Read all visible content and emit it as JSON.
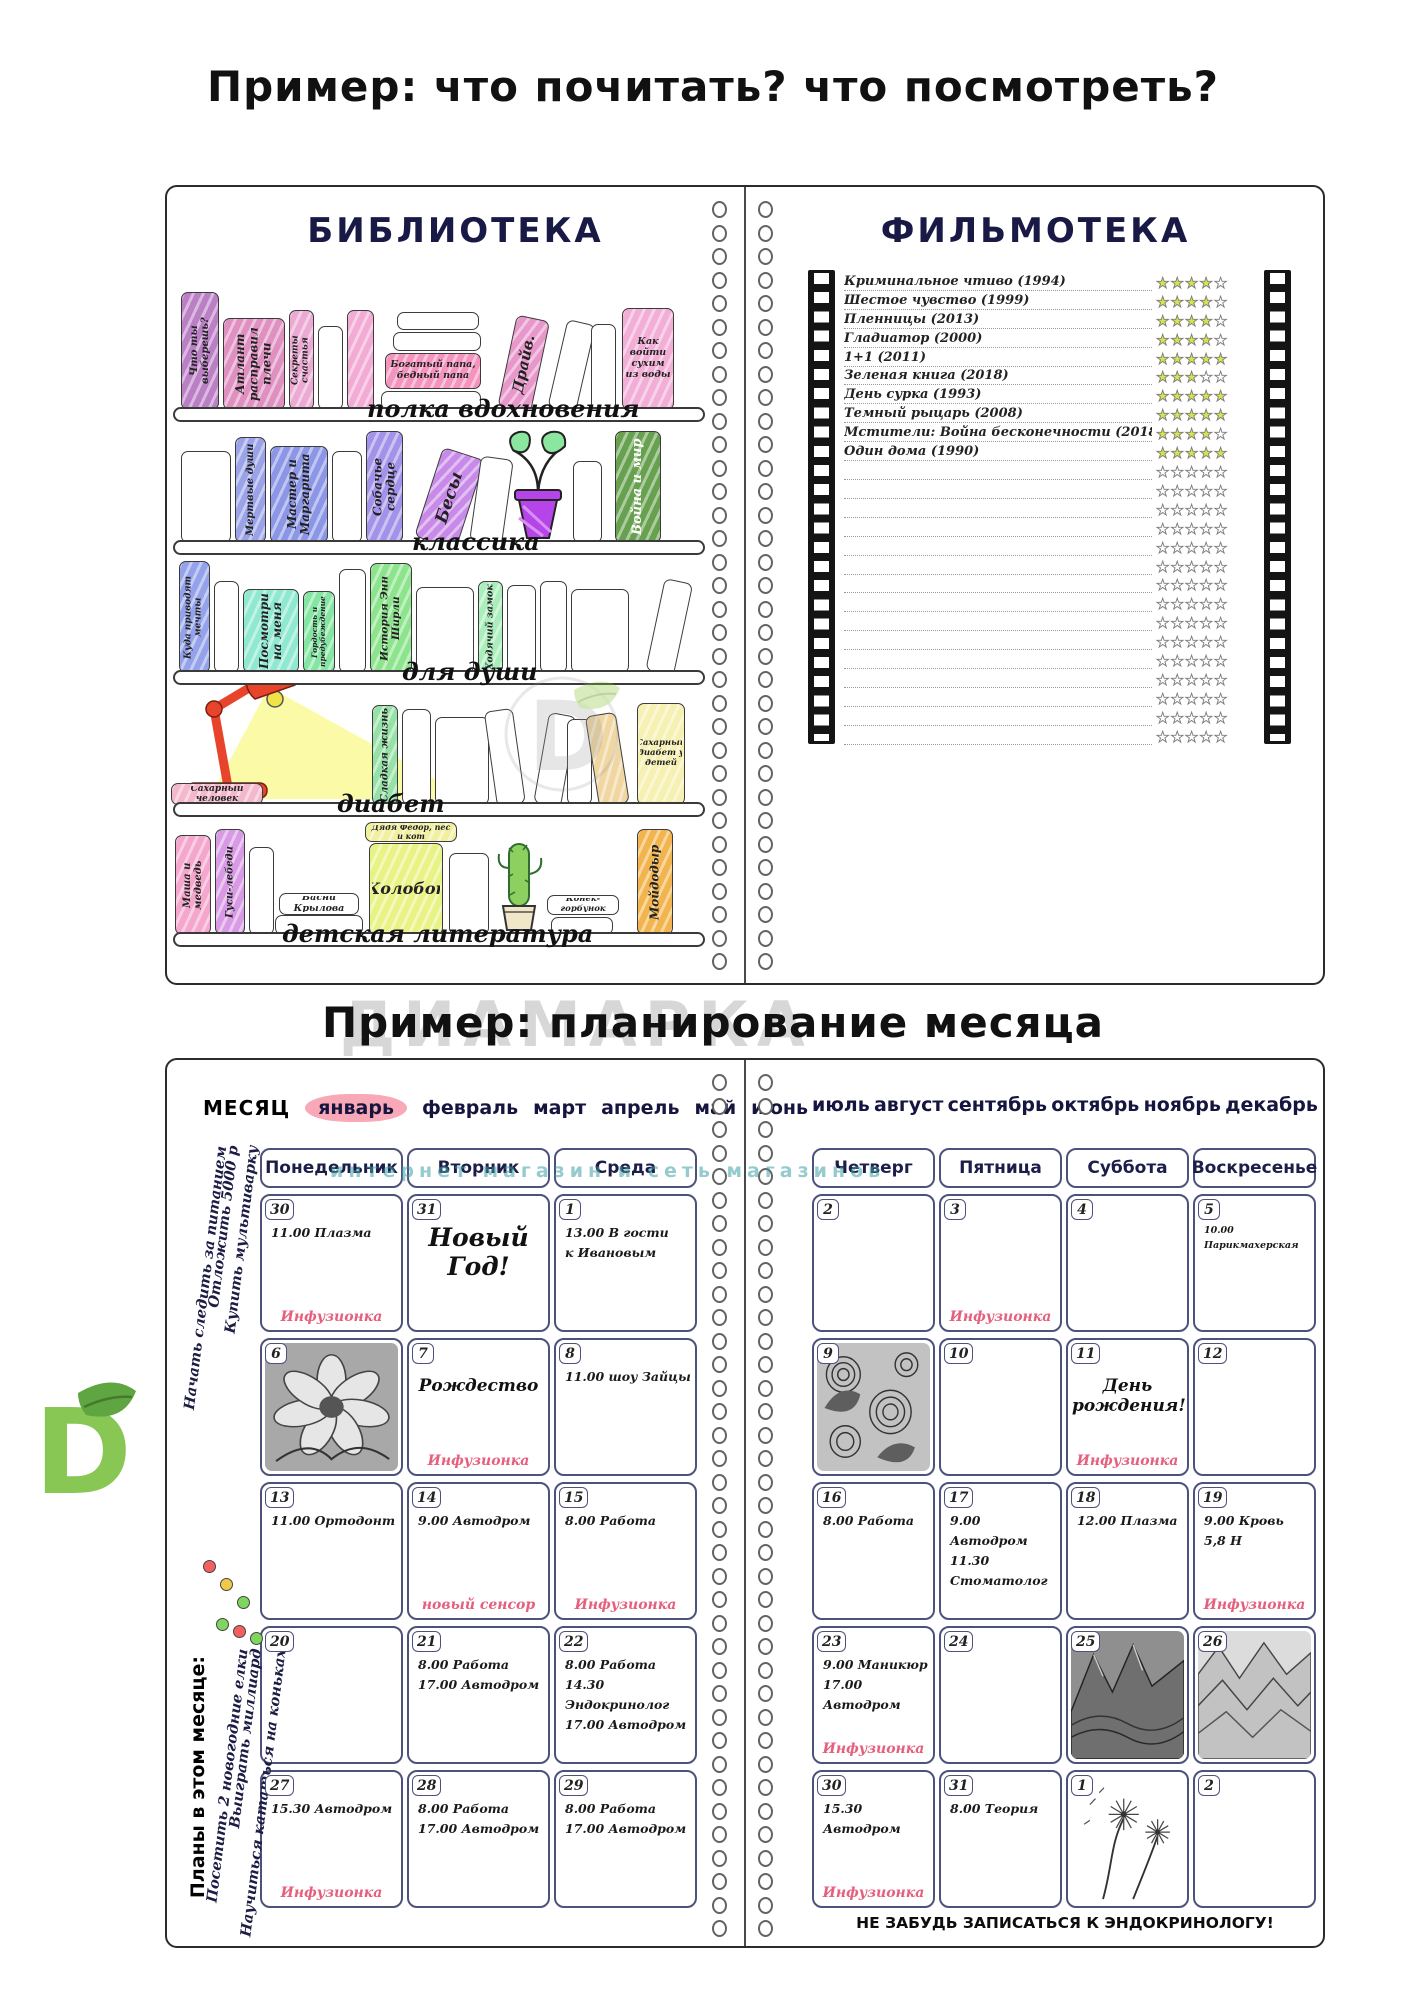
{
  "titles": {
    "example1": "Пример: что почитать? что посмотреть?",
    "example2": "Пример: планирование месяца"
  },
  "colors": {
    "navy_title": "#191946",
    "accent_red": "#e4607c",
    "star_fill": "#d7e44e",
    "month_highlight": "#f8a8b6"
  },
  "library": {
    "title": "БИБЛИОТЕКА",
    "shelves": [
      {
        "label": "полка вдохновения",
        "bar": 220,
        "label_x": 200,
        "books": [
          {
            "t": "Что ты выберешь?",
            "c": "#bb7fc6",
            "x": 14,
            "w": 38,
            "h": 118,
            "fs": 10
          },
          {
            "t": "Атлант расправил плечи",
            "c": "#df8fc0",
            "x": 56,
            "w": 62,
            "h": 92,
            "fs": 12
          },
          {
            "t": "Секреты счастья",
            "c": "#eba9d4",
            "x": 122,
            "w": 25,
            "h": 100,
            "fs": 9
          },
          {
            "c": "#ffffff",
            "x": 151,
            "w": 25,
            "h": 84
          },
          {
            "c": "#f2abd4",
            "x": 180,
            "w": 27,
            "h": 100
          },
          {
            "c": "#ffffff",
            "x": 214,
            "w": 100,
            "h": 19,
            "lying": 1,
            "b": 0
          },
          {
            "t": "Богатый папа, бедный папа",
            "c": "#f493be",
            "x": 218,
            "w": 96,
            "h": 36,
            "lying": 1,
            "b": 21,
            "fs": 9.5
          },
          {
            "c": "#ffffff",
            "x": 226,
            "w": 88,
            "h": 19,
            "lying": 1,
            "b": 59
          },
          {
            "c": "#ffffff",
            "x": 230,
            "w": 82,
            "h": 18,
            "lying": 1,
            "b": 80
          },
          {
            "t": "Драйв.",
            "c": "#e897ca",
            "x": 330,
            "w": 34,
            "h": 94,
            "tilt": 12,
            "fs": 15
          },
          {
            "c": "#ffffff",
            "x": 380,
            "w": 29,
            "h": 90,
            "tilt": 13
          },
          {
            "c": "#ffffff",
            "x": 424,
            "w": 25,
            "h": 86
          },
          {
            "t": "Как войти сухим из воды",
            "c": "#f2aed6",
            "x": 455,
            "w": 52,
            "h": 102,
            "hl": 1,
            "fs": 9.5
          }
        ]
      },
      {
        "label": "классика",
        "bar": 353,
        "label_x": 245,
        "books": [
          {
            "c": "#ffffff",
            "x": 14,
            "w": 50,
            "h": 92
          },
          {
            "t": "Мертвые души",
            "c": "#9aa2e8",
            "x": 68,
            "w": 31,
            "h": 106,
            "fs": 10
          },
          {
            "t": "Мастер и Маргарита",
            "c": "#8c96e6",
            "x": 103,
            "w": 58,
            "h": 97,
            "fs": 12
          },
          {
            "c": "#ffffff",
            "x": 165,
            "w": 30,
            "h": 92
          },
          {
            "t": "Собачье сердце",
            "c": "#a392ea",
            "x": 199,
            "w": 37,
            "h": 112,
            "fs": 12
          },
          {
            "t": "Бесы",
            "c": "#c88ae8",
            "x": 246,
            "w": 44,
            "h": 94,
            "tilt": 18,
            "fs": 17
          },
          {
            "c": "#ffffff",
            "x": 302,
            "w": 33,
            "h": 86,
            "tilt": 8
          },
          {
            "c": "#ffffff",
            "x": 406,
            "w": 29,
            "h": 82
          },
          {
            "t": "Война и мир",
            "c": "#67a04e",
            "x": 448,
            "w": 46,
            "h": 112,
            "fs": 13,
            "tc": "#ffffff"
          }
        ]
      },
      {
        "label": "для души",
        "bar": 483,
        "label_x": 235,
        "books": [
          {
            "t": "Куда приводят мечты",
            "c": "#93a2ea",
            "x": 12,
            "w": 31,
            "h": 112,
            "fs": 9
          },
          {
            "c": "#ffffff",
            "x": 47,
            "w": 25,
            "h": 92
          },
          {
            "t": "Посмотри на меня",
            "c": "#8fe8d0",
            "x": 76,
            "w": 56,
            "h": 84,
            "fs": 12
          },
          {
            "t": "Гордость и предубеждение",
            "c": "#84e6a2",
            "x": 136,
            "w": 32,
            "h": 82,
            "fs": 7.5
          },
          {
            "c": "#ffffff",
            "x": 172,
            "w": 27,
            "h": 104
          },
          {
            "t": "История Энн Ширли",
            "c": "#8ce48c",
            "x": 203,
            "w": 42,
            "h": 110,
            "fs": 10.5
          },
          {
            "c": "#ffffff",
            "x": 249,
            "w": 58,
            "h": 86
          },
          {
            "t": "Ходячий замок",
            "c": "#aaeebc",
            "x": 311,
            "w": 25,
            "h": 92,
            "fs": 9.5
          },
          {
            "c": "#ffffff",
            "x": 340,
            "w": 29,
            "h": 88
          },
          {
            "c": "#ffffff",
            "x": 373,
            "w": 27,
            "h": 92
          },
          {
            "c": "#ffffff",
            "x": 404,
            "w": 58,
            "h": 84
          },
          {
            "c": "#ffffff",
            "x": 478,
            "w": 29,
            "h": 94,
            "tilt": 12
          }
        ]
      },
      {
        "label": "диабет",
        "bar": 615,
        "label_x": 170,
        "books": [
          {
            "t": "Сахарный человек",
            "c": "#f4b8cc",
            "x": 4,
            "w": 92,
            "h": 22,
            "lying": 1,
            "b": 0,
            "fs": 9
          },
          {
            "t": "Сладкая жизнь",
            "c": "#96e2a6",
            "x": 205,
            "w": 26,
            "h": 100,
            "fs": 10
          },
          {
            "c": "#ffffff",
            "x": 235,
            "w": 29,
            "h": 96
          },
          {
            "c": "#ffffff",
            "x": 268,
            "w": 54,
            "h": 88
          },
          {
            "c": "#ffffff",
            "x": 330,
            "w": 29,
            "h": 96,
            "tilt": -8
          },
          {
            "c": "#ffffff",
            "x": 366,
            "w": 28,
            "h": 92,
            "tilt": 10
          },
          {
            "c": "#ffffff",
            "x": 400,
            "w": 25,
            "h": 86
          },
          {
            "c": "#f0d6a0",
            "x": 432,
            "w": 31,
            "h": 92,
            "tilt": -9
          },
          {
            "t": "Сахарный диабет у детей",
            "c": "#f6f0b2",
            "x": 470,
            "w": 48,
            "h": 102,
            "hl": 1,
            "fs": 8.5
          }
        ]
      },
      {
        "label": "детская литература",
        "bar": 745,
        "label_x": 115,
        "books": [
          {
            "t": "Маша и медведь",
            "c": "#f4a6cc",
            "x": 8,
            "w": 36,
            "h": 100,
            "fs": 10
          },
          {
            "t": "Гуси-лебеди",
            "c": "#d89ae4",
            "x": 48,
            "w": 30,
            "h": 106,
            "fs": 10
          },
          {
            "c": "#ffffff",
            "x": 82,
            "w": 25,
            "h": 88
          },
          {
            "c": "#ffffff",
            "x": 108,
            "w": 88,
            "h": 20,
            "lying": 1,
            "b": 0
          },
          {
            "t": "Басни Крылова",
            "c": "#ffffff",
            "x": 112,
            "w": 80,
            "h": 22,
            "lying": 1,
            "b": 20,
            "fs": 9.5
          },
          {
            "t": "Колобок",
            "c": "#e9f284",
            "x": 202,
            "w": 74,
            "h": 92,
            "hl": 1,
            "fs": 16
          },
          {
            "t": "Дядя Фёдор, пёс и кот",
            "c": "#f2f0a0",
            "x": 198,
            "w": 92,
            "h": 20,
            "lying": 1,
            "b": 93,
            "fs": 8
          },
          {
            "c": "#ffffff",
            "x": 282,
            "w": 40,
            "h": 82
          },
          {
            "t": "Конёк-горбунок",
            "c": "#ffffff",
            "x": 380,
            "w": 72,
            "h": 20,
            "lying": 1,
            "b": 20,
            "fs": 8.5
          },
          {
            "c": "#ffffff",
            "x": 384,
            "w": 62,
            "h": 18,
            "lying": 1,
            "b": 0
          },
          {
            "t": "Мойдодыр",
            "c": "#f2b44c",
            "x": 470,
            "w": 36,
            "h": 106,
            "fs": 12
          }
        ]
      }
    ]
  },
  "filmoteka": {
    "title": "ФИЛЬМОТЕКА",
    "max_stars": 5,
    "total_rows": 25,
    "films": [
      {
        "name": "Криминальное чтиво (1994)",
        "rating": 4
      },
      {
        "name": "Шестое чувство (1999)",
        "rating": 4
      },
      {
        "name": "Пленницы (2013)",
        "rating": 4
      },
      {
        "name": "Гладиатор (2000)",
        "rating": 4
      },
      {
        "name": "1+1 (2011)",
        "rating": 5
      },
      {
        "name": "Зеленая книга (2018)",
        "rating": 3
      },
      {
        "name": "День сурка (1993)",
        "rating": 5
      },
      {
        "name": "Темный рыцарь (2008)",
        "rating": 5
      },
      {
        "name": "Мстители: Война бесконечности (2018)",
        "rating": 4
      },
      {
        "name": "Один дома (1990)",
        "rating": 5
      }
    ]
  },
  "calendar": {
    "month_label": "МЕСЯЦ",
    "selected_month": "январь",
    "months_left": [
      "январь",
      "февраль",
      "март",
      "апрель",
      "май",
      "июнь"
    ],
    "months_right": [
      "июль",
      "август",
      "сентябрь",
      "октябрь",
      "ноябрь",
      "декабрь"
    ],
    "days_left": [
      "Понедельник",
      "Вторник",
      "Среда"
    ],
    "days_right": [
      "Четверг",
      "Пятница",
      "Суббота",
      "Воскресенье"
    ],
    "goals": [
      {
        "text": "Начать следить за питанием",
        "dot": "#f26060"
      },
      {
        "text": "Отложить 5000 р",
        "dot": "#f2c84b"
      },
      {
        "text": "Купить мультиварку",
        "dot": "#7fd65f"
      }
    ],
    "plans_title": "Планы в этом месяце:",
    "plans": [
      {
        "text": "Посетить 2 новогодние елки",
        "dot": "#7fd65f"
      },
      {
        "text": "Выиграть миллиард",
        "dot": "#f26060"
      },
      {
        "text": "Научиться кататься на коньках",
        "dot": "#7fd65f"
      }
    ],
    "left_cells": [
      {
        "d": "30",
        "lines": [
          "11.00 Плазма"
        ],
        "accent": "Инфузионка"
      },
      {
        "d": "31",
        "big": "Новый Год!"
      },
      {
        "d": "1",
        "lines": [
          "13.00 В гости",
          "к Ивановым"
        ]
      },
      {
        "d": "6",
        "img": "flower"
      },
      {
        "d": "7",
        "big2": "Рождество",
        "accent": "Инфузионка"
      },
      {
        "d": "8",
        "lines": [
          "11.00 шоу Зайцы"
        ]
      },
      {
        "d": "13",
        "lines": [
          "11.00 Ортодонт"
        ]
      },
      {
        "d": "14",
        "lines": [
          "9.00 Автодром"
        ],
        "accent": "новый сенсор"
      },
      {
        "d": "15",
        "lines": [
          "8.00 Работа"
        ],
        "accent": "Инфузионка"
      },
      {
        "d": "20"
      },
      {
        "d": "21",
        "lines": [
          "8.00 Работа",
          "17.00 Автодром"
        ]
      },
      {
        "d": "22",
        "lines": [
          "8.00 Работа",
          "14.30 Эндокринолог",
          "17.00 Автодром"
        ]
      },
      {
        "d": "27",
        "lines": [
          "15.30 Автодром"
        ],
        "accent": "Инфузионка"
      },
      {
        "d": "28",
        "lines": [
          "8.00 Работа",
          "17.00 Автодром"
        ]
      },
      {
        "d": "29",
        "lines": [
          "8.00 Работа",
          "17.00 Автодром"
        ]
      }
    ],
    "right_cells": [
      {
        "d": "2"
      },
      {
        "d": "3",
        "accent": "Инфузионка"
      },
      {
        "d": "4"
      },
      {
        "d": "5",
        "lines": [
          "10.00 Парикмахерская"
        ],
        "small": 1
      },
      {
        "d": "9",
        "img": "paisley"
      },
      {
        "d": "10"
      },
      {
        "d": "11",
        "big2": "День рождения!",
        "accent": "Инфузионка"
      },
      {
        "d": "12"
      },
      {
        "d": "16",
        "lines": [
          "8.00 Работа"
        ]
      },
      {
        "d": "17",
        "lines": [
          "9.00 Автодром",
          "11.30 Стоматолог"
        ]
      },
      {
        "d": "18",
        "lines": [
          "12.00 Плазма"
        ]
      },
      {
        "d": "19",
        "lines": [
          "9.00 Кровь",
          "5,8 Н"
        ],
        "accent": "Инфузионка"
      },
      {
        "d": "23",
        "lines": [
          "9.00 Маникюр",
          "17.00 Автодром"
        ],
        "accent": "Инфузионка"
      },
      {
        "d": "24"
      },
      {
        "d": "25",
        "img": "mountains"
      },
      {
        "d": "26",
        "img": "ridges"
      },
      {
        "d": "30",
        "lines": [
          "15.30 Автодром"
        ],
        "accent": "Инфузионка"
      },
      {
        "d": "31",
        "lines": [
          "8.00 Теория"
        ]
      },
      {
        "d": "1",
        "img": "dandelion"
      },
      {
        "d": "2"
      }
    ],
    "footer_note": "НЕ ЗАБУДЬ ЗАПИСАТЬСЯ К ЭНДОКРИНОЛОГУ!"
  },
  "watermark": {
    "brand": "ДИАМАРКА",
    "subtitle": "интернет магазин и сеть магазинов"
  }
}
